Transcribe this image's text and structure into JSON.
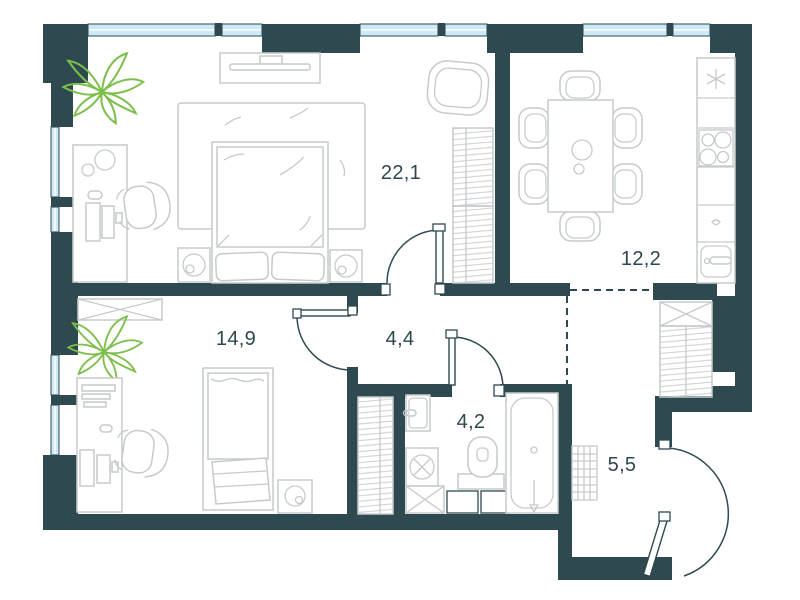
{
  "rooms": [
    {
      "id": "living-bedroom",
      "area": "22,1"
    },
    {
      "id": "kitchen-dining",
      "area": "12,2"
    },
    {
      "id": "bedroom",
      "area": "14,9"
    },
    {
      "id": "hallway",
      "area": "4,4"
    },
    {
      "id": "bathroom",
      "area": "4,2"
    },
    {
      "id": "entrance-hall",
      "area": "5,5"
    }
  ],
  "colors": {
    "wall": "#2e4a50",
    "window_glass": "#cde8f7",
    "furniture_outline": "#c6cacc",
    "plant": "#7cbf4a",
    "label_text": "#2e474d",
    "background": "#ffffff"
  }
}
